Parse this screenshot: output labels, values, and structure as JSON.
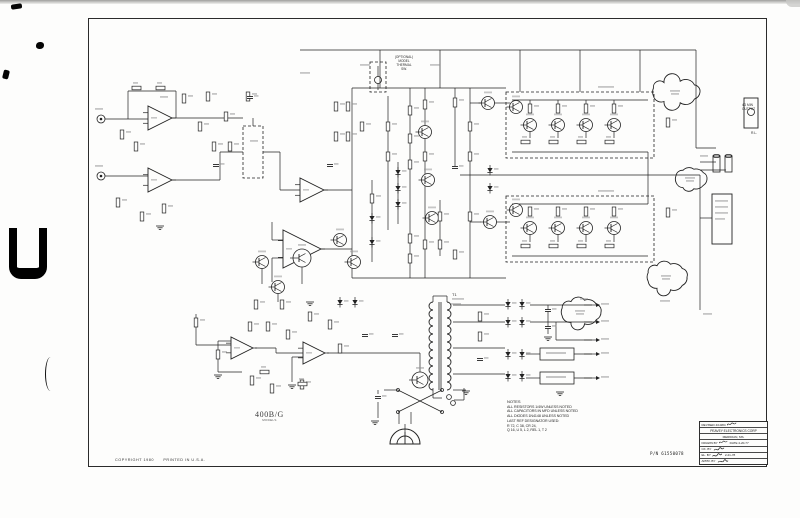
{
  "schematic": {
    "model_label": "400B/G",
    "model_sublabel": "MODELS",
    "copyright_line": "COPYRIGHT 1980      PRINTED IN U.S.A.",
    "part_number": "P/N 61550078"
  },
  "notes": {
    "title": "NOTES",
    "lines": [
      "ALL RESISTORS 1/4W UNLESS NOTED",
      "ALL CAPACITORS IN MFD UNLESS NOTED",
      "ALL DIODES 1N4148 UNLESS NOTED",
      "LAST REF DESIGNATOR USED:",
      "R 72, C 38, CR 24,",
      "Q 16, U 5, L 2, REL 1, T 2"
    ]
  },
  "title_block": {
    "revised": "REVISED 4/10/84",
    "company": "PEAVEY ELECTRONICS CORP",
    "city": "MERIDIAN, MS.",
    "drawn_by": "DRAWN BY",
    "drawn_date": "DATE 4-20-77",
    "checked_by": "CK. BY",
    "el_by": "EL. BY",
    "el_date": "2-21-78",
    "approved_by": "APPR. BY"
  },
  "annotations": {
    "optional_block": [
      "(OPTIONAL)",
      "MODEL",
      "THERMAL",
      "SW."
    ],
    "output_jack_line1": "4Ω MIN",
    "output_jack_line2": "OUTPUT",
    "load_label": "R.L.",
    "transformer_label": "T1"
  },
  "colors": {
    "ink": "#222222",
    "paper": "#fdfdfc"
  }
}
